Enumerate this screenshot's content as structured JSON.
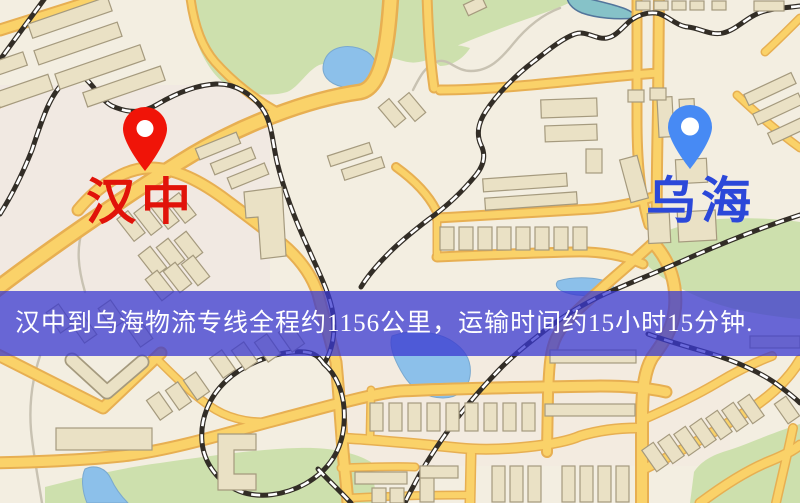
{
  "banner": {
    "text": "汉中到乌海物流专线全程约1156公里，运输时间约15小时15分钟.",
    "distance_km": "1156",
    "duration": "15小时15分钟"
  },
  "markers": {
    "origin": {
      "label": "汉中"
    },
    "destination": {
      "label": "乌海"
    }
  },
  "colors": {
    "map_background": "#f3eee1",
    "road_yellow": "#fad269",
    "road_casing": "#e7af52",
    "park_green": "#cde0ad",
    "water_blue": "#8cc0ea",
    "building_fill": "#eae1c5",
    "building_stroke": "#a59a7e",
    "railway_dark": "#322d26",
    "banner_bg": "rgba(58,56,208,0.75)",
    "banner_text": "#ffffff",
    "origin_accent": "#e11309",
    "origin_pin": "#f01408",
    "destination_accent": "#2b48d9",
    "destination_pin": "#478af4"
  }
}
